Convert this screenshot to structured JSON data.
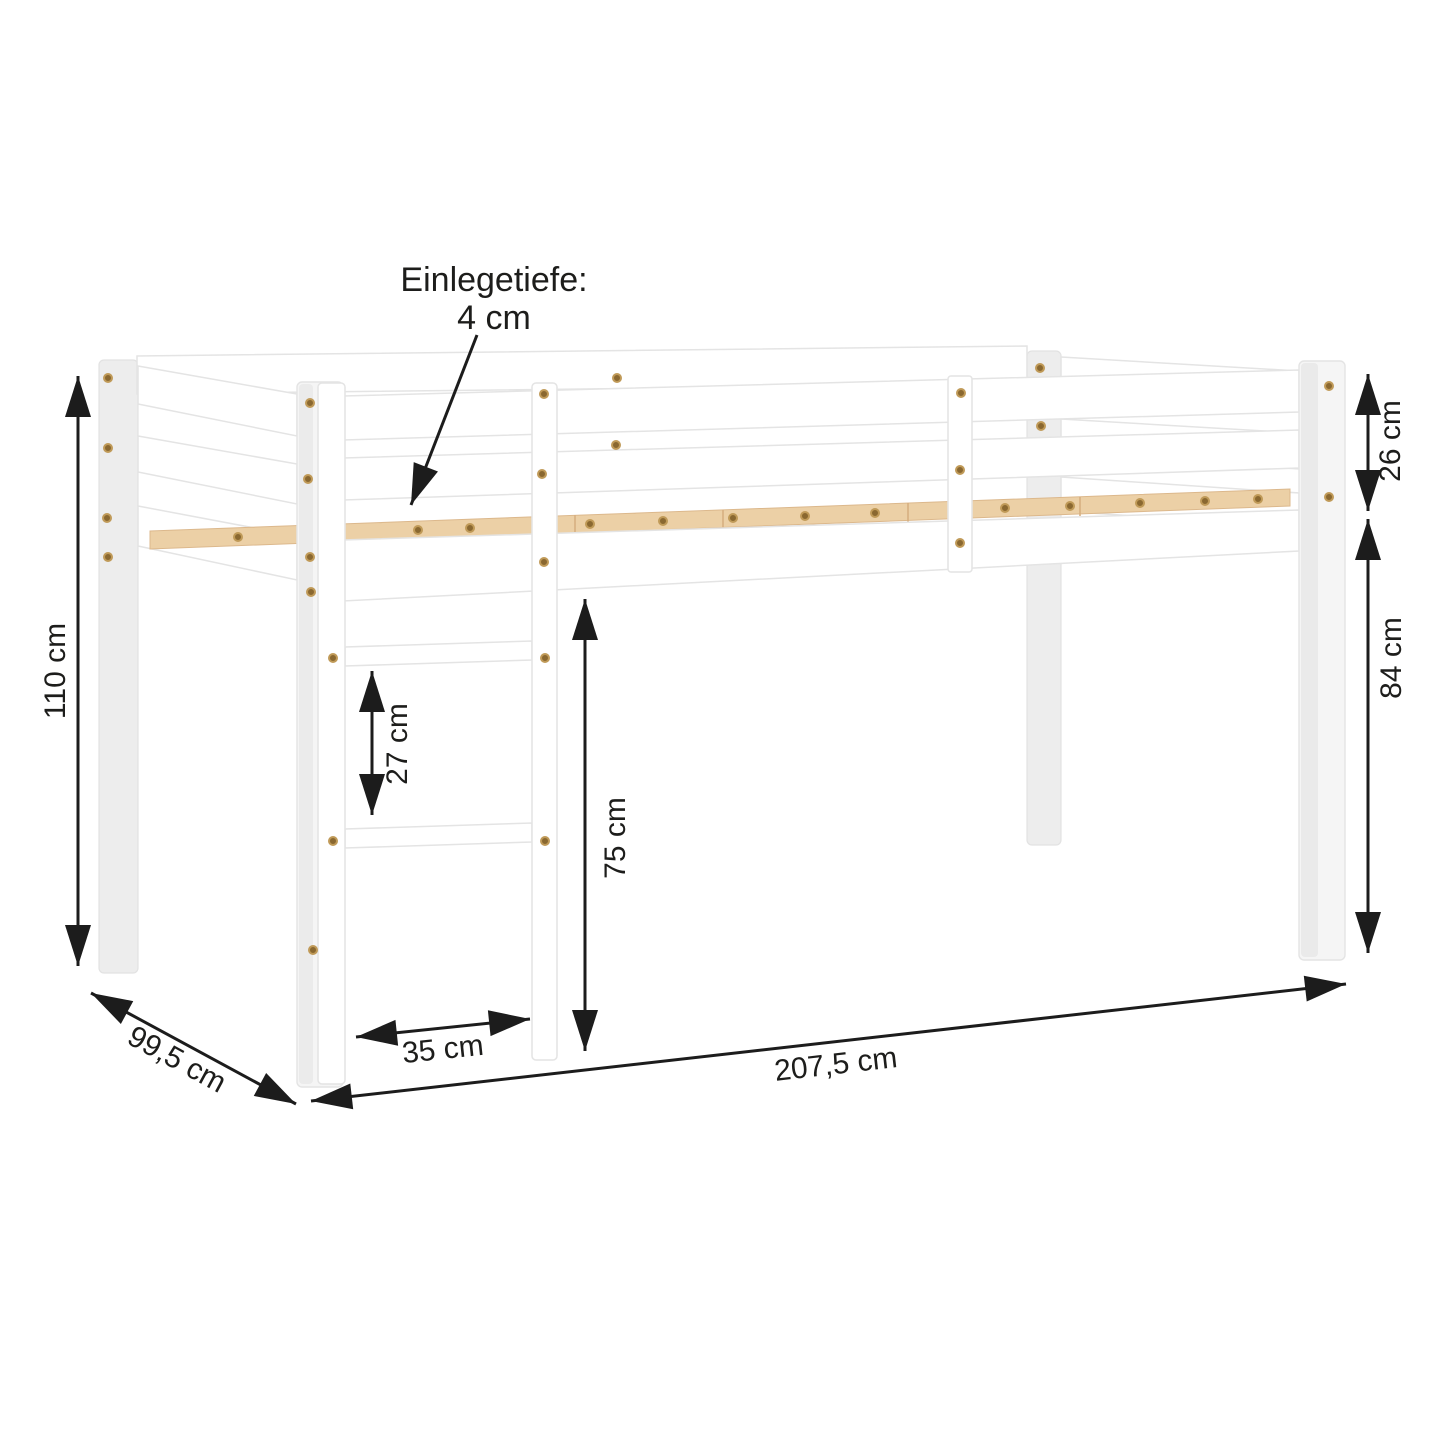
{
  "diagram": {
    "subject": "loft-bed-dimension-diagram",
    "annotation": {
      "line1": "Einlegetiefe:",
      "line2": "4 cm"
    },
    "dimensions": {
      "total_height": "110 cm",
      "depth": "99,5 cm",
      "guard_rail_height": "26 cm",
      "leg_height": "84 cm",
      "rung_spacing": "27 cm",
      "under_bed_clearance": "75 cm",
      "ladder_width": "35 cm",
      "total_length": "207,5 cm"
    },
    "colors": {
      "background": "#ffffff",
      "arrow": "#1c1c1c",
      "frame": "#ffffff",
      "frame_edge": "#e4e4e4",
      "wood_slat": "#ecd0a6",
      "screw": "#8a6830"
    }
  }
}
